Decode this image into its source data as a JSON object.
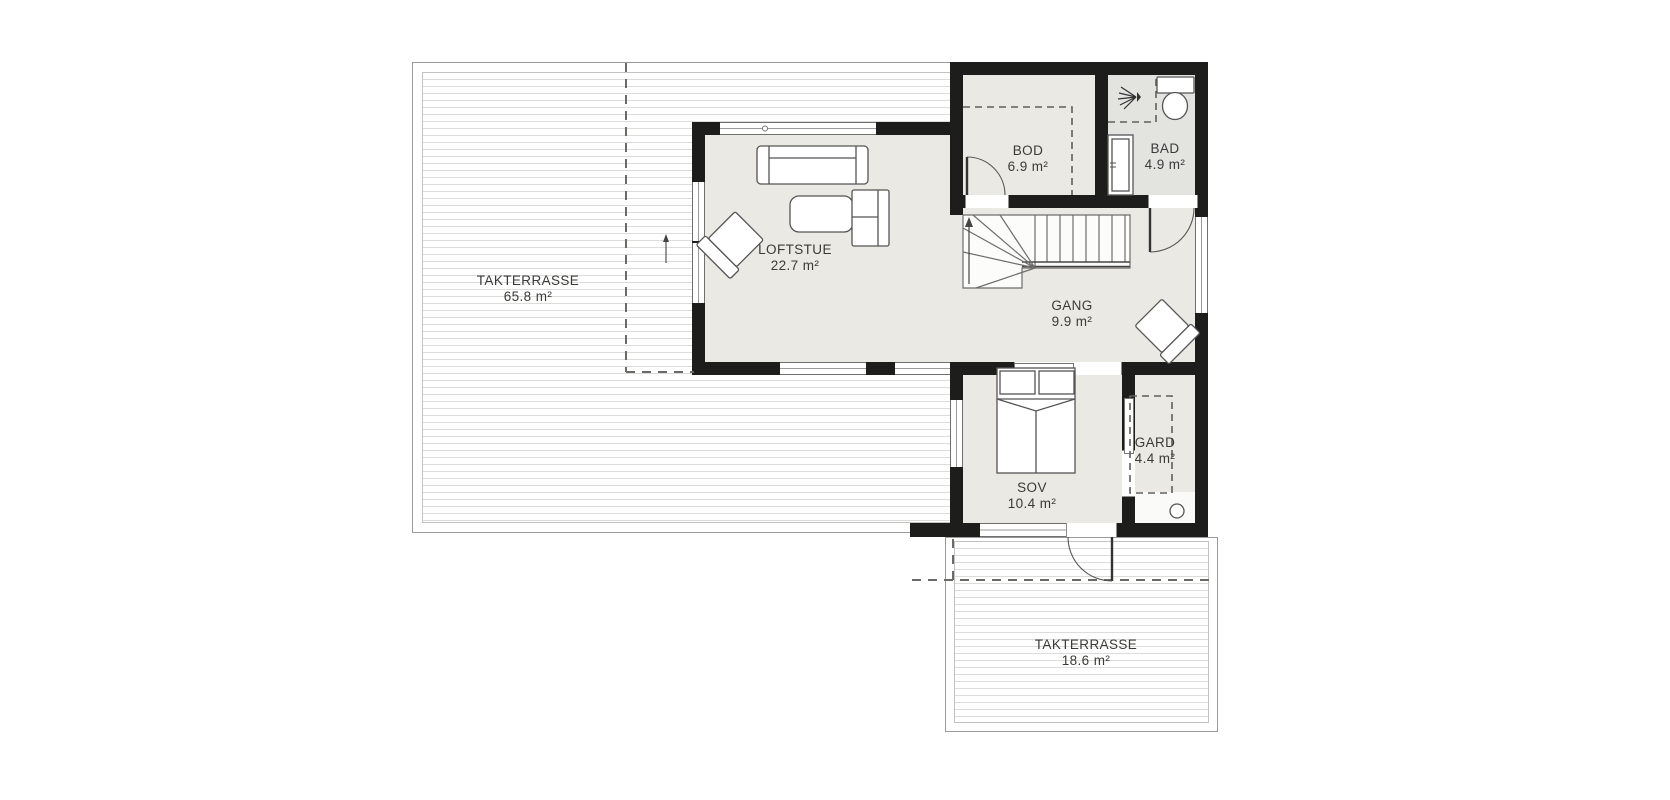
{
  "plan": {
    "rooms": [
      {
        "name": "TAKTERRASSE",
        "area": "65.8 m²"
      },
      {
        "name": "LOFTSTUE",
        "area": "22.7 m²"
      },
      {
        "name": "BOD",
        "area": "6.9 m²"
      },
      {
        "name": "BAD",
        "area": "4.9 m²"
      },
      {
        "name": "GANG",
        "area": "9.9 m²"
      },
      {
        "name": "SOV",
        "area": "10.4 m²"
      },
      {
        "name": "GARD",
        "area": "4.4 m²"
      },
      {
        "name": "TAKTERRASSE",
        "area": "18.6 m²"
      }
    ],
    "colors": {
      "wall": "#1d1d1b",
      "floor": "#eae9e3",
      "floor-bath": "#e3e3e0",
      "deck-line": "#dcdcdb",
      "outline": "#5f5f5d",
      "text": "#3a3a38",
      "dash": "#6a6a68"
    }
  }
}
